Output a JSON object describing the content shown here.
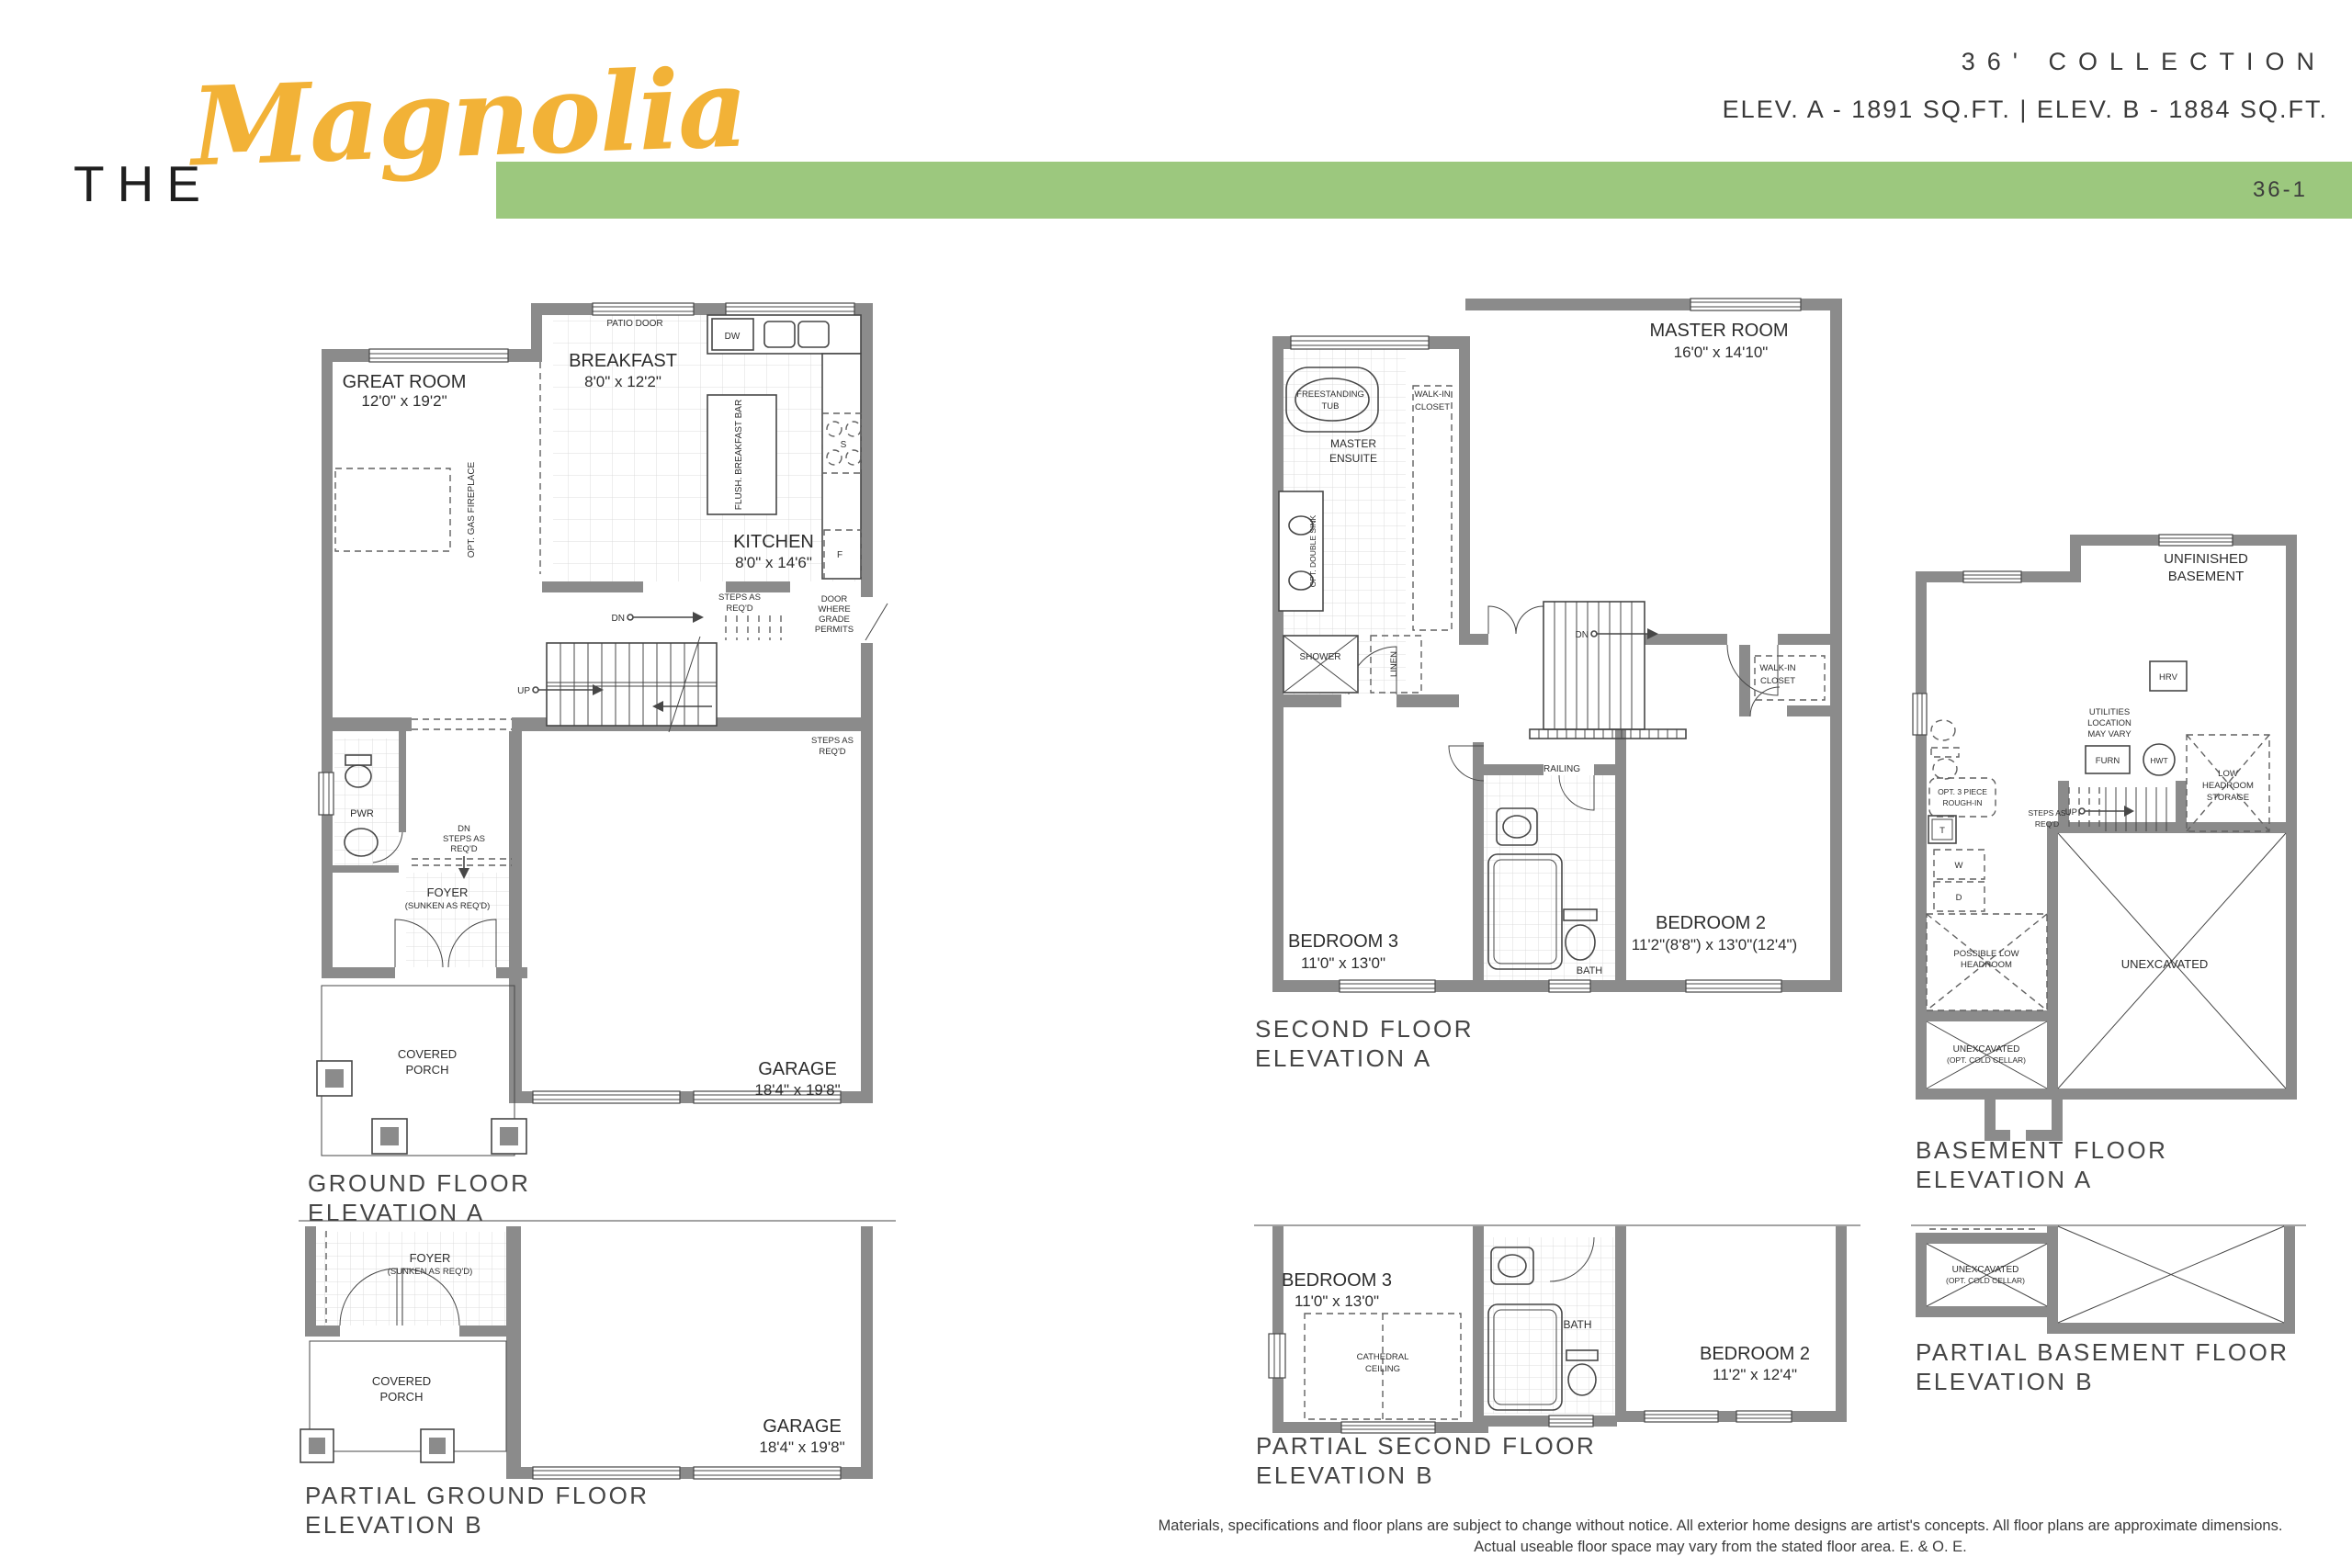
{
  "header": {
    "title_prefix": "THE",
    "title_name": "Magnolia",
    "collection": "36' COLLECTION",
    "elevations": "ELEV. A - 1891 SQ.FT.  |  ELEV. B - 1884 SQ.FT.",
    "sheet_code": "36-1",
    "accent_yellow": "#F2B237",
    "accent_green": "#9CC87E"
  },
  "ground_a": {
    "title1": "GROUND FLOOR",
    "title2": "ELEVATION A",
    "great_room": "GREAT ROOM",
    "great_room_dims": "12'0\" x 19'2\"",
    "breakfast": "BREAKFAST",
    "breakfast_dims": "8'0\" x 12'2\"",
    "kitchen": "KITCHEN",
    "kitchen_dims": "8'0\" x 14'6\"",
    "garage": "GARAGE",
    "garage_dims": "18'4\" x 19'8\"",
    "patio_door": "PATIO DOOR",
    "dw": "DW",
    "stove": "S",
    "fridge": "F",
    "flush_bar": "FLUSH. BREAKFAST BAR",
    "opt_fireplace": "OPT. GAS FIREPLACE",
    "steps1a": "STEPS AS",
    "steps1b": "REQ'D",
    "dn1": "DN",
    "door_grade1": "DOOR",
    "door_grade2": "WHERE",
    "door_grade3": "GRADE",
    "door_grade4": "PERMITS",
    "steps2a": "STEPS AS",
    "steps2b": "REQ'D",
    "up": "UP",
    "pwr": "PWR",
    "dn_steps1": "DN",
    "dn_steps2": "STEPS AS",
    "dn_steps3": "REQ'D",
    "foyer": "FOYER",
    "foyer_sub": "(SUNKEN AS REQ'D)",
    "porch1": "COVERED",
    "porch2": "PORCH"
  },
  "second_a": {
    "title1": "SECOND FLOOR",
    "title2": "ELEVATION A",
    "master": "MASTER ROOM",
    "master_dims": "16'0\" x 14'10\"",
    "tub1": "FREESTANDING",
    "tub2": "TUB",
    "ensuite1": "MASTER",
    "ensuite2": "ENSUITE",
    "wic1a": "WALK-IN",
    "wic1b": "CLOSET",
    "wic2a": "WALK-IN",
    "wic2b": "CLOSET",
    "opt_double_sink": "OPT. DOUBLE SINK",
    "shower": "SHOWER",
    "linen": "LINEN",
    "dn": "DN",
    "railing": "RAILING",
    "bath": "BATH",
    "bed3": "BEDROOM 3",
    "bed3_dims": "11'0\" x 13'0\"",
    "bed2": "BEDROOM 2",
    "bed2_dims": "11'2\"(8'8\") x 13'0\"(12'4\")"
  },
  "basement_a": {
    "title1": "BASEMENT FLOOR",
    "title2": "ELEVATION A",
    "unfinished1": "UNFINISHED",
    "unfinished2": "BASEMENT",
    "utilities1": "UTILITIES",
    "utilities2": "LOCATION",
    "utilities3": "MAY VARY",
    "hrv": "HRV",
    "furn": "FURN",
    "hwt": "HWT",
    "storage1": "LOW",
    "storage2": "HEADROOM",
    "storage3": "STORAGE",
    "roughin1": "OPT. 3 PIECE",
    "roughin2": "ROUGH-IN",
    "steps1": "STEPS AS",
    "steps2": "REQ'D",
    "up": "UP",
    "t": "T",
    "w": "W",
    "d": "D",
    "possible1": "POSSIBLE LOW",
    "possible2": "HEADROOM",
    "unexcavated": "UNEXCAVATED",
    "cold1": "UNEXCAVATED",
    "cold2": "(OPT. COLD CELLAR)"
  },
  "ground_b": {
    "title1": "PARTIAL GROUND FLOOR",
    "title2": "ELEVATION B",
    "foyer": "FOYER",
    "foyer_sub": "(SUNKEN AS REQ'D)",
    "porch1": "COVERED",
    "porch2": "PORCH",
    "garage": "GARAGE",
    "garage_dims": "18'4\" x 19'8\""
  },
  "second_b": {
    "title1": "PARTIAL SECOND FLOOR",
    "title2": "ELEVATION B",
    "bed3": "BEDROOM 3",
    "bed3_dims": "11'0\" x 13'0\"",
    "cath1": "CATHEDRAL",
    "cath2": "CEILING",
    "bath": "BATH",
    "bed2": "BEDROOM 2",
    "bed2_dims": "11'2\" x 12'4\""
  },
  "basement_b": {
    "title1": "PARTIAL BASEMENT FLOOR",
    "title2": "ELEVATION B",
    "cold1": "UNEXCAVATED",
    "cold2": "(OPT. COLD CELLAR)"
  },
  "footer": {
    "line1": "Materials, specifications and floor plans are subject to change without notice. All exterior home designs are artist's concepts. All floor plans are approximate dimensions.",
    "line2": "Actual useable floor space may vary from the stated floor area. E. & O. E."
  }
}
